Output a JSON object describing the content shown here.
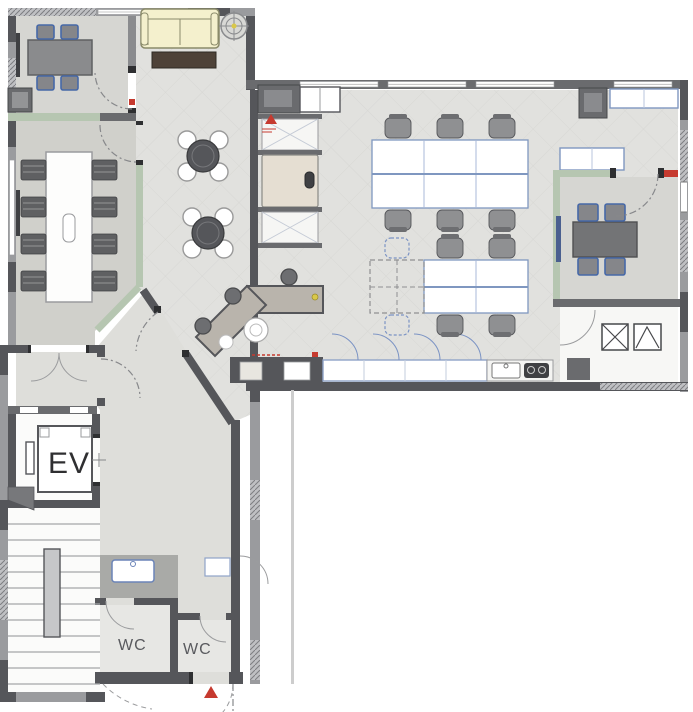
{
  "labels": {
    "elevator": "EV",
    "wc_left": "WC",
    "wc_right": "WC"
  },
  "markers": {
    "hall_entrance_icon": "entrance-triangle",
    "office_entrance_icon": "entrance-triangle",
    "duct_left_icon": "duct-x-symbol",
    "duct_right_icon": "duct-chevron-symbol",
    "compass_icon": "ceiling-survey-mark"
  },
  "colors": {
    "wall": "#55565a",
    "wallLight": "#9a9b9e",
    "wallMid": "#6a6b6e",
    "partition": "#b6c6b1",
    "partitionEdge": "#7e9377",
    "floorHall": "#e1e1de",
    "floorRoom": "#d6d6d2",
    "floorConf": "#d0d0cb",
    "floorCorridor": "#dededa",
    "floorWc": "#e7e7e4",
    "deskStroke": "#7f97c0",
    "deskGrid": "#a8b9d8",
    "chairGray": "#8f9092",
    "chairDark": "#5f6062",
    "chairBlue": "#4668a8",
    "tableGray": "#737476",
    "counterTop": "#b9b4ac",
    "sofaCream": "#f4f0cd",
    "sofaEdge": "#8a8a6a",
    "woodDark": "#4e4238",
    "applianceDark": "#3f4043",
    "doorBeige": "#e5ded2",
    "blueArc": "#7b93c4",
    "sinkBlue": "#6b84b8",
    "stool": "#6d6e71",
    "red": "#c63a2f",
    "yellow": "#d9c84a"
  }
}
